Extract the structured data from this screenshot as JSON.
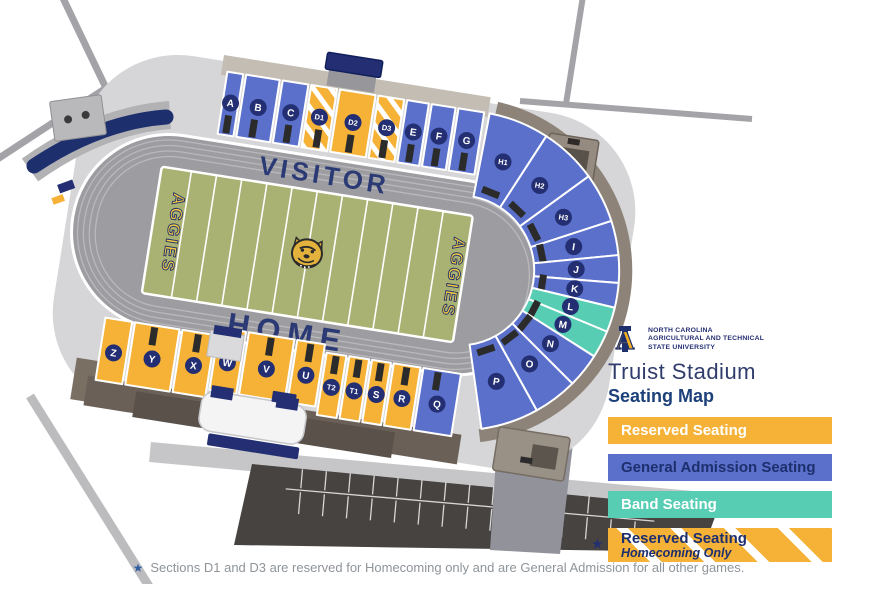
{
  "header": {
    "university_lines": [
      "North Carolina",
      "Agricultural and Technical",
      "State University"
    ],
    "stadium_name": "Truist Stadium",
    "map_title": "Seating Map"
  },
  "field": {
    "visitor_label": "VISITOR",
    "home_label": "HOME",
    "endzone_left": "AGGIES",
    "endzone_right": "AGGIES"
  },
  "colors": {
    "reserved": "#F6B237",
    "general": "#5A70CB",
    "band": "#57CDB4",
    "navy": "#232F72",
    "title_dark": "#303C6B",
    "title_blue": "#1C4079",
    "note_gray": "#8F9499",
    "field_green": "#A9B173",
    "track_gray": "#9D9DA1",
    "stripe_white": "#FFFFFF"
  },
  "legend": [
    {
      "label": "Reserved Seating",
      "type": "reserved",
      "text_color": "#FFFFFF"
    },
    {
      "label": "General Admission Seating",
      "type": "general",
      "text_color": "#1E2F6E"
    },
    {
      "label": "Band Seating",
      "type": "band",
      "text_color": "#FFFFFF"
    },
    {
      "label": "Reserved Seating",
      "sublabel": "Homecoming Only",
      "type": "homecoming",
      "text_color": "#1E2F6E",
      "star": "★"
    }
  ],
  "sections": [
    {
      "id": "A",
      "type": "general"
    },
    {
      "id": "B",
      "type": "general"
    },
    {
      "id": "C",
      "type": "general"
    },
    {
      "id": "D1",
      "type": "homecoming"
    },
    {
      "id": "D2",
      "type": "reserved"
    },
    {
      "id": "D3",
      "type": "homecoming"
    },
    {
      "id": "E",
      "type": "general"
    },
    {
      "id": "F",
      "type": "general"
    },
    {
      "id": "G",
      "type": "general"
    },
    {
      "id": "H1",
      "type": "general"
    },
    {
      "id": "H2",
      "type": "general"
    },
    {
      "id": "H3",
      "type": "general"
    },
    {
      "id": "I",
      "type": "general"
    },
    {
      "id": "J",
      "type": "general"
    },
    {
      "id": "K",
      "type": "general"
    },
    {
      "id": "L",
      "type": "band"
    },
    {
      "id": "M",
      "type": "band"
    },
    {
      "id": "N",
      "type": "general"
    },
    {
      "id": "O",
      "type": "general"
    },
    {
      "id": "P",
      "type": "general"
    },
    {
      "id": "Q",
      "type": "general"
    },
    {
      "id": "R",
      "type": "reserved"
    },
    {
      "id": "S",
      "type": "reserved"
    },
    {
      "id": "T1",
      "type": "reserved"
    },
    {
      "id": "T2",
      "type": "reserved"
    },
    {
      "id": "U",
      "type": "reserved"
    },
    {
      "id": "V",
      "type": "reserved"
    },
    {
      "id": "W",
      "type": "reserved"
    },
    {
      "id": "X",
      "type": "reserved"
    },
    {
      "id": "Y",
      "type": "reserved"
    },
    {
      "id": "Z",
      "type": "reserved"
    }
  ],
  "footnote": {
    "star": "★",
    "text": "Sections D1 and D3 are reserved for Homecoming only and are General Admission for all other games."
  }
}
